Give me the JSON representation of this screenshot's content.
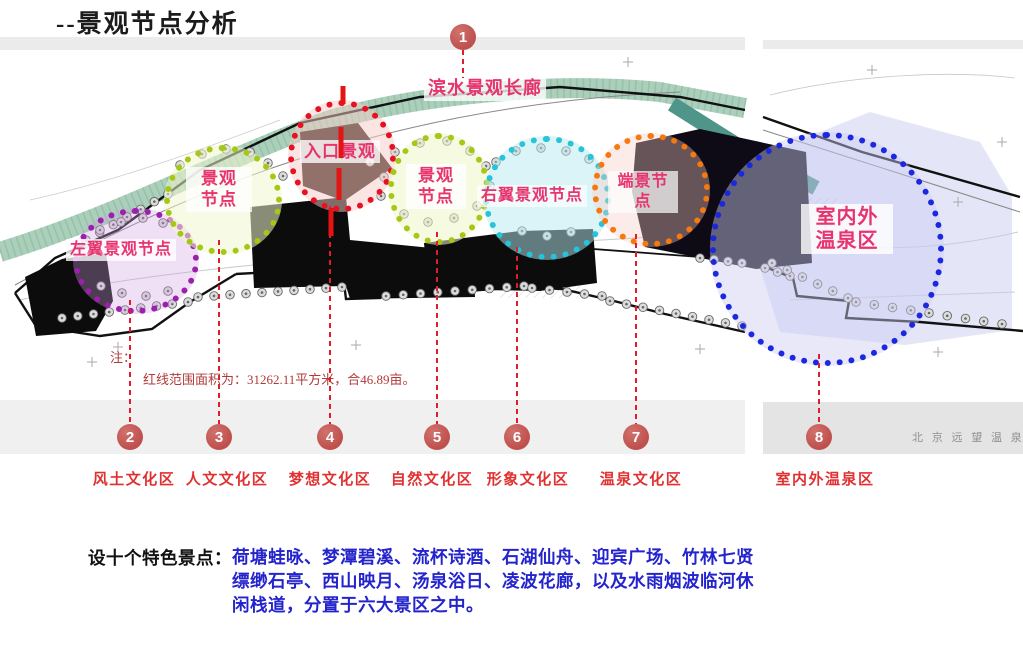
{
  "title": "--景观节点分析",
  "corridor": {
    "num": "1",
    "label": "滨水景观长廊"
  },
  "circles": {
    "left_wing": "左翼景观节点",
    "node_a_l1": "景观",
    "node_a_l2": "节点",
    "entrance": "入口景观",
    "node_b_l1": "景观",
    "node_b_l2": "节点",
    "right_wing": "右翼景观节点",
    "end_l1": "端景节",
    "end_l2": "点",
    "spring_l1": "室内外",
    "spring_l2": "温泉区"
  },
  "nodes": [
    {
      "num": "2",
      "zone": "风土文化区"
    },
    {
      "num": "3",
      "zone": "人文文化区"
    },
    {
      "num": "4",
      "zone": "梦想文化区"
    },
    {
      "num": "5",
      "zone": "自然文化区"
    },
    {
      "num": "6",
      "zone": "形象文化区"
    },
    {
      "num": "7",
      "zone": "温泉文化区"
    },
    {
      "num": "8",
      "zone": "室内外温泉区"
    }
  ],
  "note": {
    "l1": "注：",
    "l2": "红线范围面积为：31262.11平方米，合46.89亩。"
  },
  "watermark": "北 京 远 望 温 泉",
  "footer": {
    "prefix": "设十个特色景点：",
    "line1": "荷塘蛙咏、梦潭碧溪、流杯诗酒、石湖仙舟、迎宾广场、竹林七贤",
    "line2": "缥缈石亭、西山映月、汤泉浴日、凌波花廊，以及水雨烟波临河休",
    "line3": "闲栈道，分置于六大景区之中。"
  },
  "colors": {
    "purple": "#9c1fae",
    "green": "#a4c814",
    "red": "#e81123",
    "cyan": "#27c3d8",
    "orange": "#f5790f",
    "blue": "#1b27e0",
    "marker": "#bf4f4c",
    "map_label": "#e8336e",
    "zone_label": "#e03131",
    "leader": "#e41b2c",
    "note": "#b03a3a",
    "footer_blue": "#2424cc",
    "watermark_gray": "#909090"
  }
}
